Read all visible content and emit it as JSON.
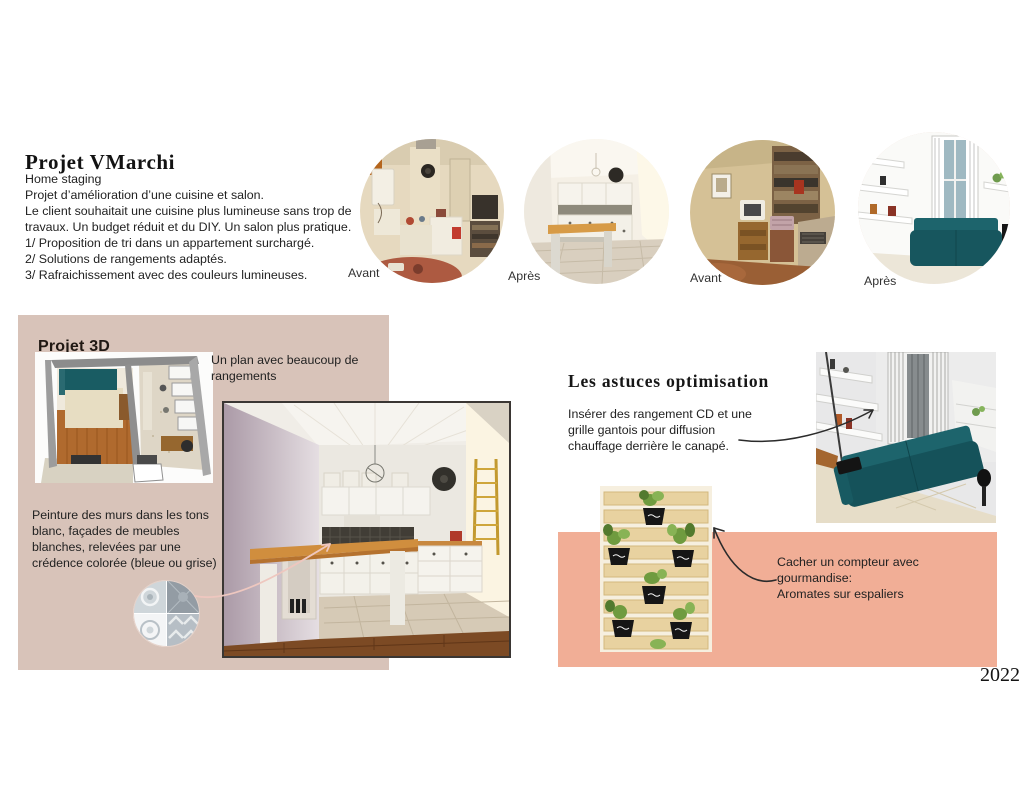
{
  "page": {
    "title": "Projet VMarchi",
    "year": "2022"
  },
  "intro": {
    "lines": [
      "Home staging",
      "Projet d’amélioration d’une cuisine et salon.",
      "Le client souhaitait une cuisine plus lumineuse sans trop de",
      "travaux. Un budget réduit et du DIY. Un salon plus pratique.",
      "1/ Proposition de tri dans un appartement surchargé.",
      "2/ Solutions de rangements adaptés.",
      "3/ Rafraichissement avec des couleurs lumineuses."
    ]
  },
  "gallery": {
    "items": [
      {
        "name": "kitchen-before-photo",
        "label": "Avant"
      },
      {
        "name": "kitchen-after-photo",
        "label": "Après"
      },
      {
        "name": "salon-before-photo",
        "label": "Avant"
      },
      {
        "name": "salon-after-render",
        "label": "Après"
      }
    ]
  },
  "projet3d": {
    "heading": "Projet 3D",
    "plan_note_lines": [
      "Un plan avec beaucoup de",
      "rangements"
    ],
    "paint_note_lines": [
      "Peinture des murs dans les tons",
      "blanc, façades de meubles",
      "blanches, relevées par une",
      "crédence colorée (bleue ou grise)"
    ],
    "panel_color": "#d8c3b9"
  },
  "astuces": {
    "heading": "Les astuces optimisation",
    "cd_note_lines": [
      "Insérer des rangement CD et une",
      "grille gantois pour diffusion",
      "chauffage derrière le  canapé."
    ],
    "compteur_note_lines": [
      "Cacher un compteur avec",
      "gourmandise:",
      "Aromates sur espaliers"
    ],
    "panel_color": "#f1ae96"
  },
  "colors": {
    "beige_panel": "#d8c3b9",
    "salmon_panel": "#f1ae96",
    "sofa_teal": "#17565e",
    "wood": "#c8883f"
  }
}
